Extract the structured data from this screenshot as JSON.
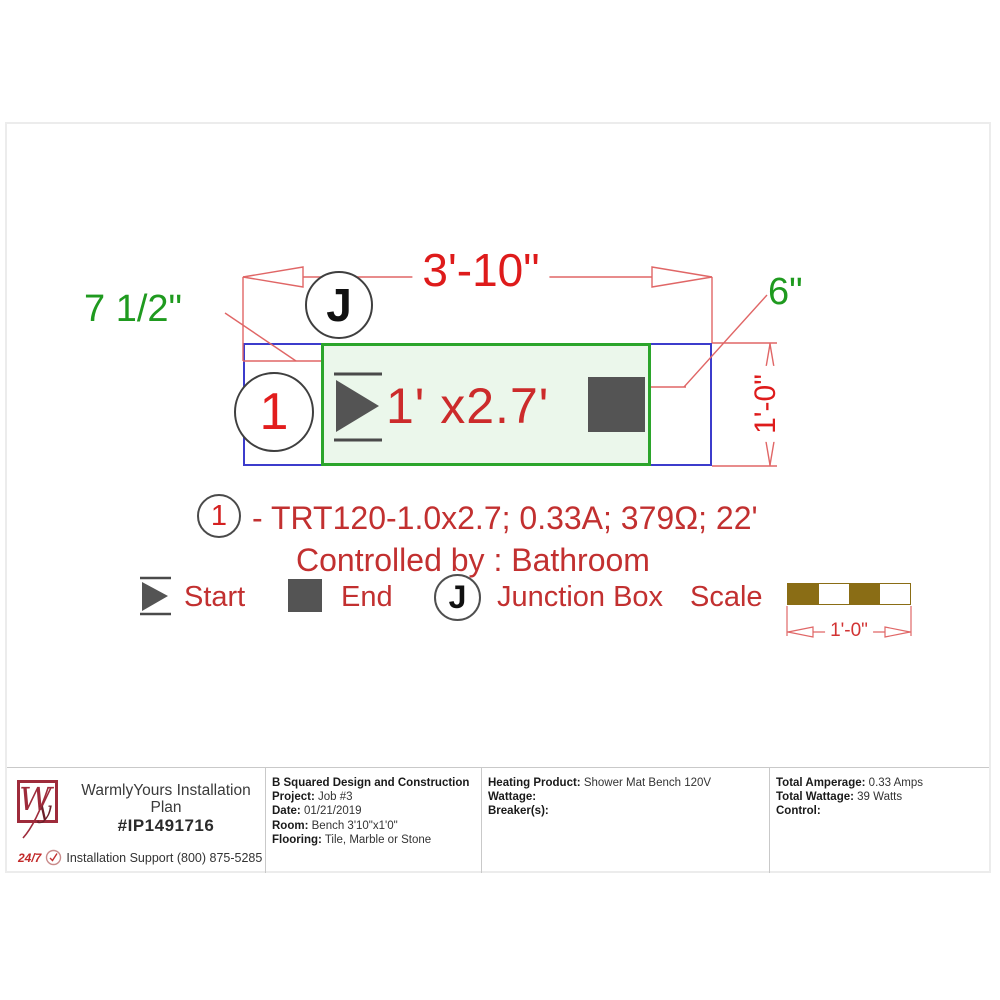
{
  "colors": {
    "dimension_line_red": "#e06666",
    "dimension_text_red": "#de1b1b",
    "annotation_red": "#c23030",
    "offset_text_green": "#1f9a1f",
    "mat_border_green": "#2ba52b",
    "mat_fill_green": "#ebf7eb",
    "room_outline_blue": "#3c3ccc",
    "icon_gray": "#545454",
    "ruler_brown": "#8a6d15",
    "logo_maroon": "#9e2b3b"
  },
  "drawing": {
    "width_dim": "3'-10\"",
    "left_offset_dim": "7 1/2\"",
    "right_offset_dim": "6\"",
    "height_dim": "1'-0\"",
    "junction_letter": "J",
    "mat_number": "1",
    "mat_size": "1' x2.7'"
  },
  "spec": {
    "number": "1",
    "description": "- TRT120-1.0x2.7; 0.33A; 379Ω; 22'",
    "controlled_by": "Controlled by : Bathroom"
  },
  "legend": {
    "start": "Start",
    "end": "End",
    "junction_letter": "J",
    "junction": "Junction Box",
    "scale": "Scale",
    "scale_dim": "1'-0\""
  },
  "footer": {
    "logo_w": "W",
    "logo_y": "y",
    "title_line1": "WarmlyYours Installation",
    "title_line2": "Plan",
    "plan_number": "#IP1491716",
    "support_badge": "24/7",
    "support_text": "Installation Support (800) 875-5285",
    "company_name": "B Squared Design and Construction",
    "project_label": "Project:",
    "project_value": "Job #3",
    "date_label": "Date:",
    "date_value": "01/21/2019",
    "room_label": "Room:",
    "room_value": "Bench 3'10\"x1'0\"",
    "flooring_label": "Flooring:",
    "flooring_value": "Tile, Marble or Stone",
    "heating_product_label": "Heating Product:",
    "heating_product_value": "Shower Mat Bench 120V",
    "wattage_label": "Wattage:",
    "breakers_label": "Breaker(s):",
    "total_amperage_label": "Total Amperage:",
    "total_amperage_value": "0.33 Amps",
    "total_wattage_label": "Total Wattage:",
    "total_wattage_value": "39 Watts",
    "control_label": "Control:"
  }
}
